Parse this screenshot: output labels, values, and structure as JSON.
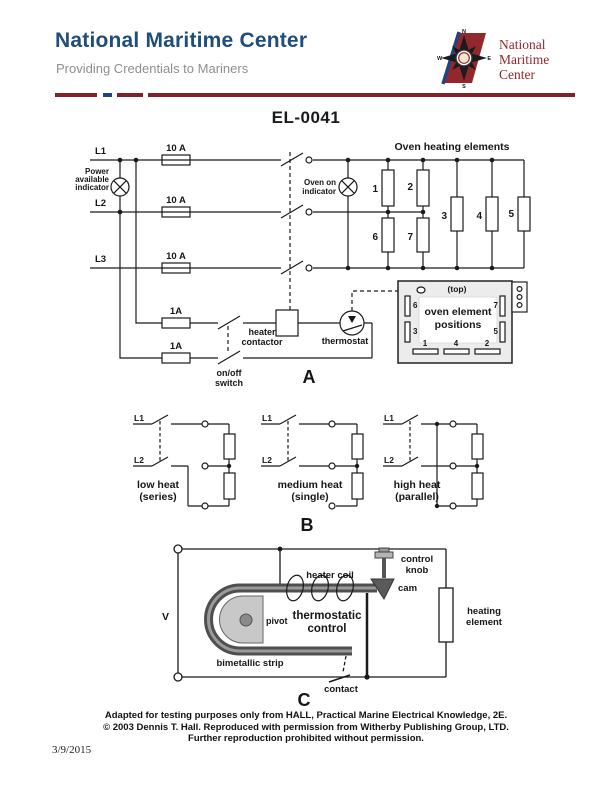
{
  "colors": {
    "title_blue": "#1e4e79",
    "tagline_gray": "#8f8f8f",
    "logo_red": "#93282c",
    "divider_red": "#7f222b",
    "divider_blue": "#24427f"
  },
  "header": {
    "title": "National Maritime Center",
    "tagline": "Providing Credentials to Mariners",
    "logo": {
      "line1": "National",
      "line2": "Maritime",
      "line3": "Center",
      "n": "N",
      "e": "E",
      "s": "S",
      "w": "W"
    }
  },
  "document": {
    "code": "EL-0041",
    "date": "3/9/2015"
  },
  "diagram_a": {
    "section_label": "A",
    "elements_title": "Oven heating elements",
    "l1": "L1",
    "l2": "L2",
    "l3": "L3",
    "fuse_l1": "10 A",
    "fuse_l2": "10 A",
    "fuse_l3": "10 A",
    "fuse_c1": "1A",
    "fuse_c2": "1A",
    "power_ind_1": "Power",
    "power_ind_2": "available",
    "power_ind_3": "indicator",
    "oven_ind_1": "Oven on",
    "oven_ind_2": "indicator",
    "n1": "1",
    "n2": "2",
    "n3": "3",
    "n4": "4",
    "n5": "5",
    "n6": "6",
    "n7": "7",
    "onoff_1": "on/off",
    "onoff_2": "switch",
    "contactor_1": "heater",
    "contactor_2": "contactor",
    "thermostat": "thermostat",
    "box": {
      "top": "(top)",
      "cap1": "oven element",
      "cap2": "positions",
      "p6": "6",
      "p7": "7",
      "p3": "3",
      "p5": "5",
      "b1": "1",
      "b4": "4",
      "b2": "2"
    }
  },
  "diagram_b": {
    "section_label": "B",
    "circuits": [
      {
        "l1": "L1",
        "l2": "L2",
        "name": "low heat",
        "mode": "(series)"
      },
      {
        "l1": "L1",
        "l2": "L2",
        "name": "medium heat",
        "mode": "(single)"
      },
      {
        "l1": "L1",
        "l2": "L2",
        "name": "high heat",
        "mode": "(parallel)"
      }
    ]
  },
  "diagram_c": {
    "section_label": "C",
    "voltage": "V",
    "heater_coil": "heater coil",
    "control_knob_1": "control",
    "control_knob_2": "knob",
    "cam": "cam",
    "pivot": "pivot",
    "thermo_1": "thermostatic",
    "thermo_2": "control",
    "bimetallic": "bimetallic strip",
    "contact": "contact",
    "heating_1": "heating",
    "heating_2": "element"
  },
  "footer": {
    "line1": "Adapted for testing purposes only from HALL, Practical Marine Electrical Knowledge, 2E.",
    "line2": "© 2003 Dennis T. Hall. Reproduced with permission from Witherby Publishing Group, LTD.",
    "line3": "Further reproduction prohibited without permission."
  }
}
